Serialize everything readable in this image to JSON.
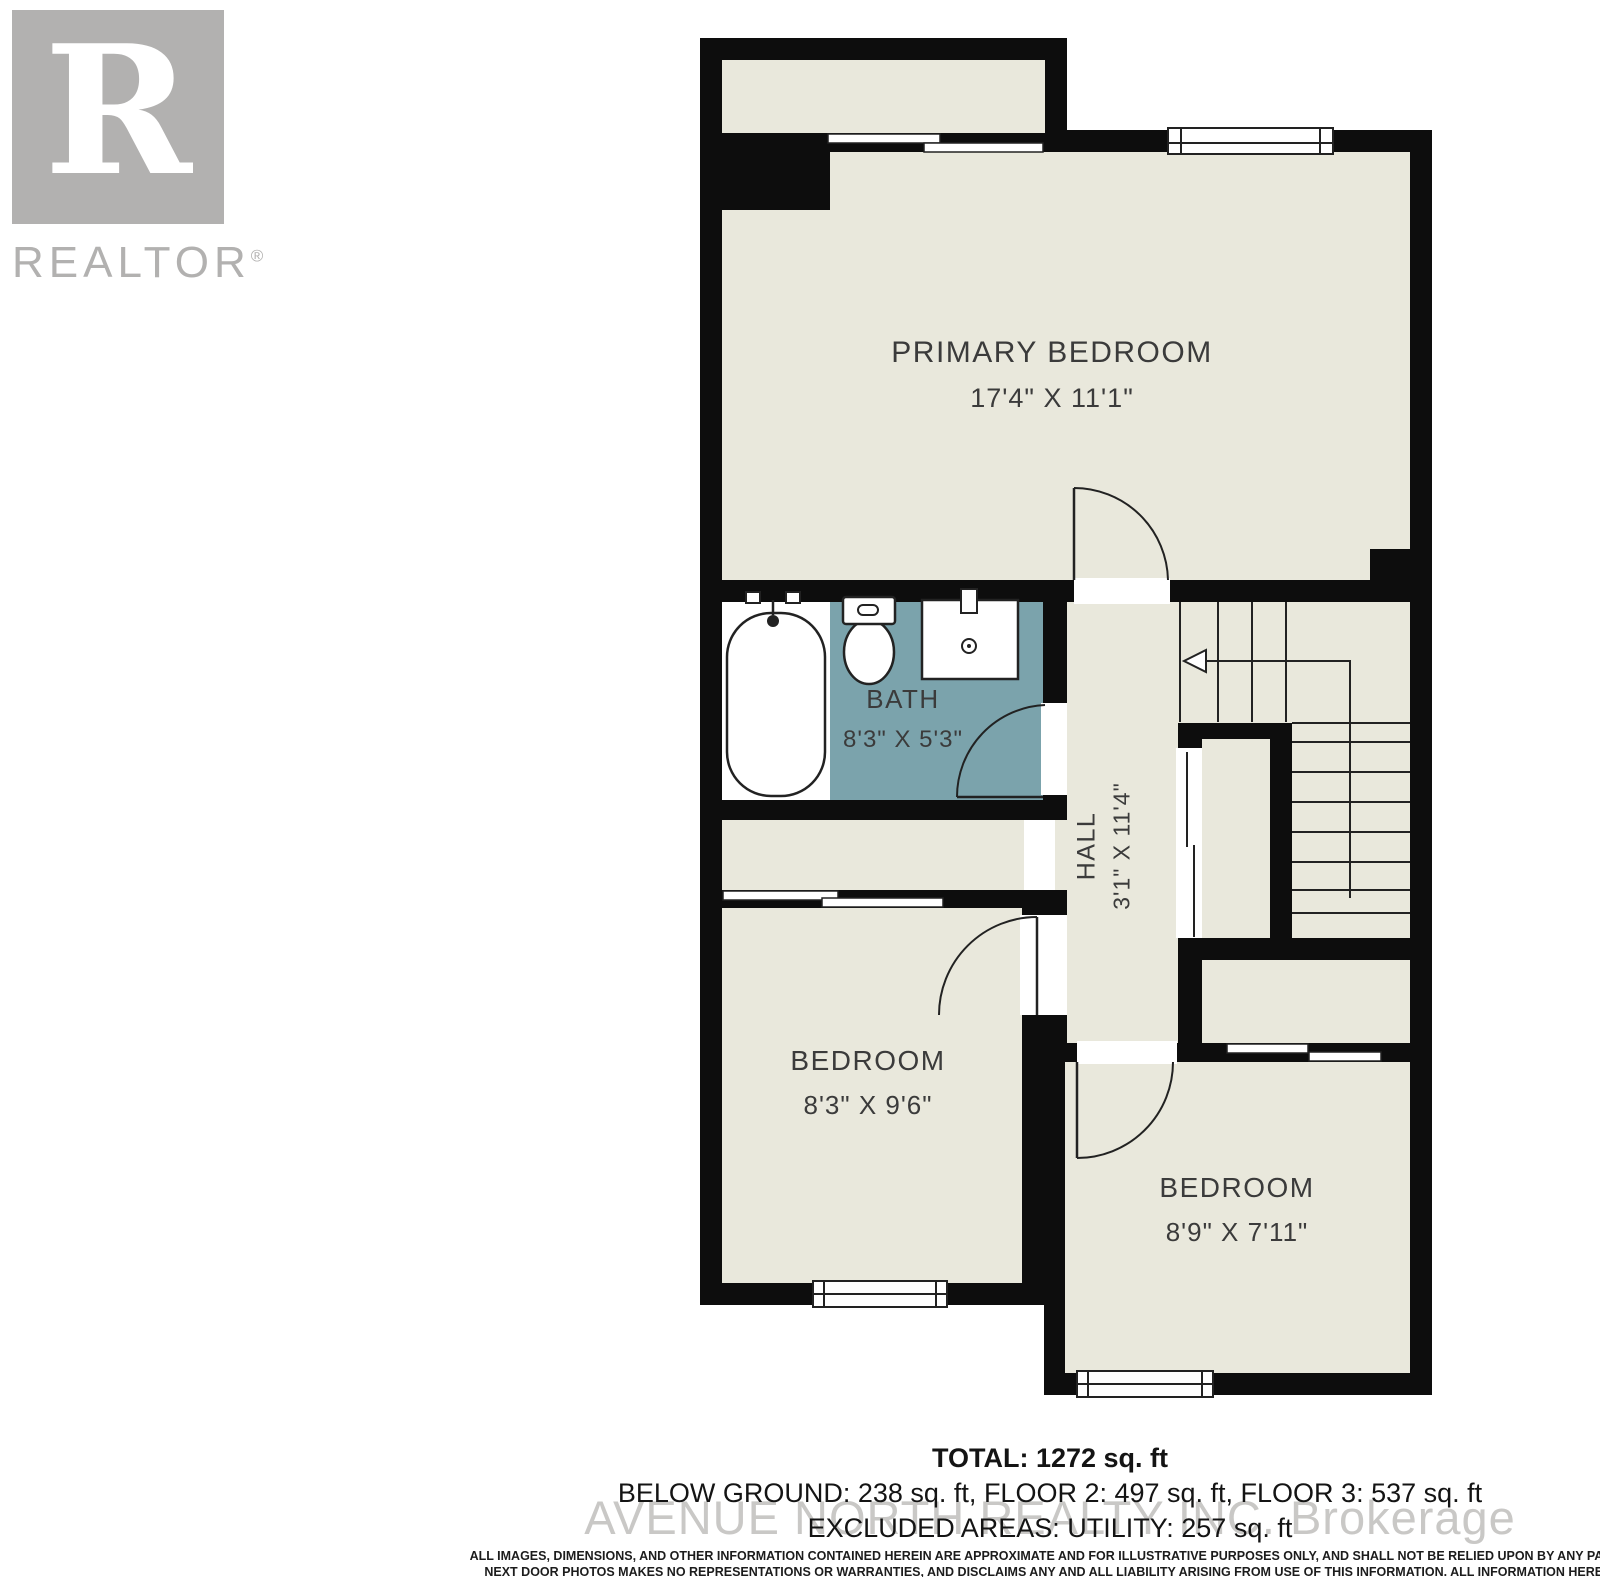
{
  "branding": {
    "logo_letter": "R",
    "logo_text": "REALTOR",
    "logo_reg": "®"
  },
  "rooms": {
    "primary": {
      "name": "PRIMARY BEDROOM",
      "dims": "17'4\" X 11'1\""
    },
    "bath": {
      "name": "BATH",
      "dims": "8'3\" X 5'3\""
    },
    "hall": {
      "name": "HALL",
      "dims": "3'1\" X 11'4\""
    },
    "bedroom_left": {
      "name": "BEDROOM",
      "dims": "8'3\" X 9'6\""
    },
    "bedroom_right": {
      "name": "BEDROOM",
      "dims": "8'9\" X 7'11\""
    }
  },
  "summary": {
    "total": "TOTAL: 1272 sq. ft",
    "floors": "BELOW GROUND: 238 sq. ft, FLOOR 2: 497 sq. ft, FLOOR 3: 537 sq. ft",
    "excluded": "EXCLUDED AREAS: UTILITY: 257 sq. ft"
  },
  "watermark": "AVENUE NORTH REALTY INC. Brokerage",
  "disclaimer": {
    "line1": "ALL IMAGES, DIMENSIONS, AND OTHER INFORMATION CONTAINED HEREIN ARE APPROXIMATE AND FOR ILLUSTRATIVE PURPOSES ONLY, AND SHALL NOT BE RELIED UPON BY ANY PARTY.",
    "line2": "NEXT DOOR PHOTOS MAKES NO REPRESENTATIONS OR WARRANTIES, AND DISCLAIMS ANY AND ALL LIABILITY ARISING FROM USE OF THIS INFORMATION. ALL INFORMATION HEREIN",
    "line3": "SHALL BE SUBJECT TO THE TERMS AND CONDITIONS FOUND AT NEXTDOORPHOTOS.COM/TC."
  },
  "colors": {
    "floor": "#e9e8dc",
    "bath_floor": "#7ba3ac",
    "wall": "#0d0d0d",
    "line": "#222222",
    "logo_gray": "#b2b1b0",
    "watermark_gray": "#c9c8c6",
    "label_text": "#3b3b3b"
  }
}
